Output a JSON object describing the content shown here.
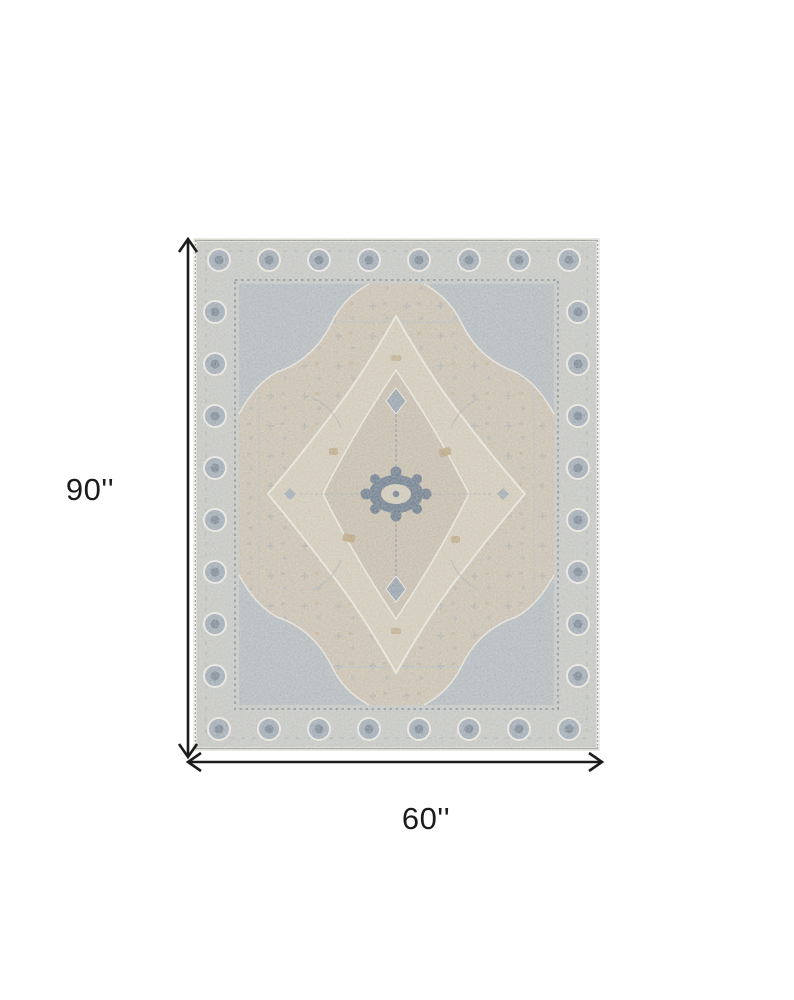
{
  "diagram": {
    "type": "product-dimension-diagram",
    "subject": "distressed-oriental-medallion-area-rug",
    "height_label": "90''",
    "width_label": "60''",
    "line_color": "#1c1c1c",
    "label_color": "#1b1b1b",
    "background": "#ffffff"
  },
  "rug": {
    "palette": {
      "edge": "#e9e7e0",
      "band": "#bfc1bd",
      "bandline": "#8f948f",
      "motif": "#97a2ad",
      "motifDark": "#6f7c89",
      "guard": "#707b87",
      "guardLight": "#d8d6cd",
      "field": "#c4baa8",
      "medallion": "#cdc4b2",
      "medallionInner": "#bfb5a3",
      "spandrel": "#a9b2ba",
      "navy": "#5f7082",
      "gold": "#b1986d",
      "outline": "#e7e4dc"
    }
  }
}
